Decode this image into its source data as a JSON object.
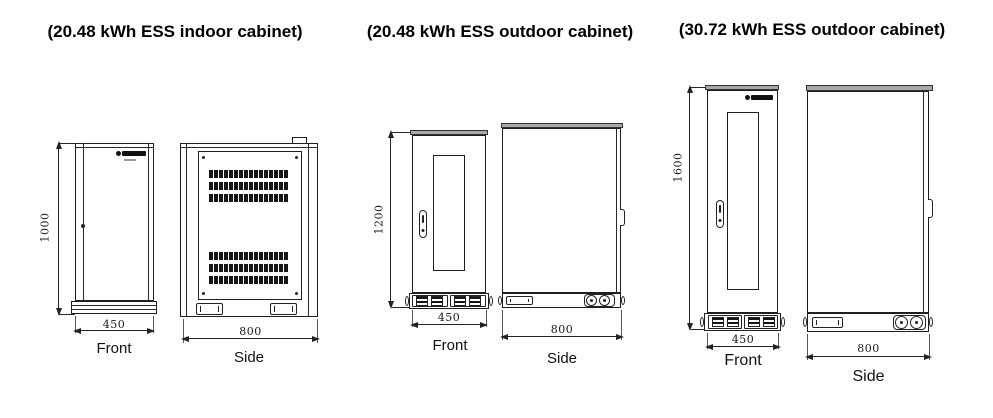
{
  "figures": [
    {
      "title": "(20.48 kWh ESS indoor cabinet)",
      "front": {
        "label": "Front",
        "width": "450",
        "height": "1000"
      },
      "side": {
        "label": "Side",
        "depth": "800"
      }
    },
    {
      "title": "(20.48 kWh ESS outdoor cabinet)",
      "front": {
        "label": "Front",
        "width": "450",
        "height": "1200"
      },
      "side": {
        "label": "Side",
        "depth": "800"
      }
    },
    {
      "title": "(30.72 kWh ESS outdoor cabinet)",
      "front": {
        "label": "Front",
        "width": "450",
        "height": "1600"
      },
      "side": {
        "label": "Side",
        "depth": "800"
      }
    }
  ],
  "icons": {
    "logo": "brand-logo"
  },
  "colors": {
    "line": "#1f1f1f",
    "lid_fill": "#a9a9a9",
    "vent_fill": "#161616",
    "background": "#ffffff"
  }
}
